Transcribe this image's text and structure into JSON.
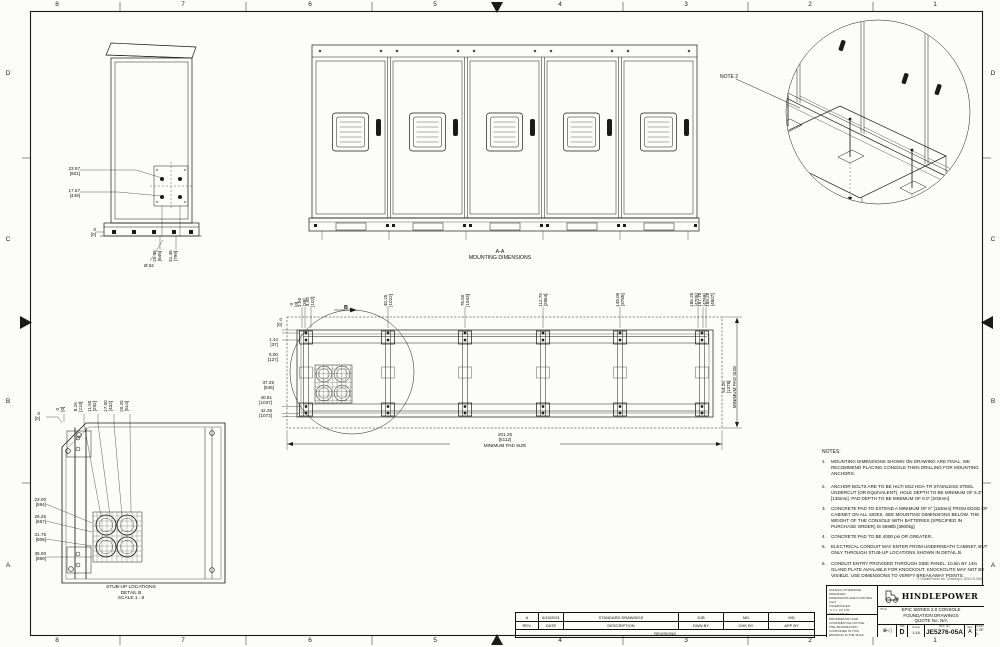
{
  "sheet": {
    "zones_h": [
      "8",
      "7",
      "6",
      "5",
      "4",
      "3",
      "2",
      "1"
    ],
    "zones_v": [
      "D",
      "C",
      "B",
      "A"
    ]
  },
  "side_view": {
    "dim_bolt_top": "23.67\n[601]",
    "dim_bolt_bot": "17.67\n[449]",
    "dim_zero": "0\n[0]",
    "dim_depth1": "25.45\n[646]",
    "dim_depth2": "31.46\n[799]",
    "dim_hole": "Ø.52"
  },
  "iso_view": {
    "note_label": "NOTE 2"
  },
  "plan_view": {
    "title": "A-A\nMOUNTING DIMENSIONS",
    "top_dims": [
      "0\n[0]",
      "1.50\n[38]",
      "4.00\n[102]",
      "40.25\n[1022]",
      "76.50\n[1943]",
      "112.75\n[2864]",
      "149.00\n[3785]",
      "185.25\n[4705]",
      "187.75\n[4769]",
      "189.25\n[4807]"
    ],
    "left_dims": [
      "0\n[0]",
      "1.44\n[37]",
      "5.00\n[127]",
      "37.25\n[946]",
      "40.81\n[1037]",
      "42.25\n[1073]"
    ],
    "right_dim": "54.25\n[1378]\nMINIMUM PAD SIZE",
    "bottom_dim": "201.25\n[5112]\nMINIMUM PAD SIZE",
    "detail_label": "B"
  },
  "detail_b": {
    "top_dims": [
      "0\n[0]",
      "8.25\n[210]",
      "11.50\n[292]",
      "17.00\n[432]",
      "20.25\n[514]"
    ],
    "left_zero": "0\n[0]",
    "left_dims": [
      "23.00\n[584]",
      "26.25\n[667]",
      "31.75\n[806]",
      "35.00\n[889]"
    ],
    "title": "STUB-UP LOCATIONS\nDETAIL B\nSCALE 1 : 8"
  },
  "notes": {
    "heading": "NOTES:",
    "items": [
      {
        "num": "1.",
        "text": "MOUNTING DIMENSIONS SHOWN ON DRAWING ARE FINAL. WE RECOMMEND PLACING CONSOLE THEN DRILLING FOR MOUNTING ANCHORS."
      },
      {
        "num": "2.",
        "text": "ANCHOR BOLTS ARE TO BE HILTI M12 HDA-TR STAINLESS STEEL UNDERCUT (OR EQUIVALENT). HOLE DEPTH TO BE MINIMUM OF 5.3\" [135mm]. PAD DEPTH TO BE MINIMUM OF 8.0\" [203mm]"
      },
      {
        "num": "3.",
        "text": "CONCRETE PAD TO EXTEND A MINIMUM OF 6\" [153mm] FROM EDGE OF CABINET ON ALL SIDES. SEE MOUNTING DIMENSIONS BELOW. THE WEIGHT OF THE CONSOLE WITH BATTERIES (SPECIFIED IN PURCHASE ORDER) IS 8598lb [3900kg]"
      },
      {
        "num": "4.",
        "text": "CONCRETE PAD TO BE 4000 psi OR GREATER."
      },
      {
        "num": "5.",
        "text": "ELECTRICAL CONDUIT MAY ENTER FROM UNDERNEATH CABINET, BUT ONLY THROUGH STUB-UP LOCATIONS SHOWN IN DETAIL B."
      },
      {
        "num": "6.",
        "text": "CONDUIT ENTRY PROVIDED THROUGH SIDE PANEL. 10.5in BY 14in GLAND PLATE AVAILABLE FOR KNOCKOUT. KNOCKOUTS MAY NOT BE VISIBLE. USE DIMENSIONS TO VERIFY BREAKAWAY POINTS."
      }
    ]
  },
  "revisions": {
    "caption": "REVISIONS",
    "headers": [
      "REV.",
      "DATE",
      "DESCRIPTION",
      "DWN BY",
      "CHK BY",
      "APP BY"
    ],
    "rows": [
      [
        "A",
        "6/15/2021",
        "STANDARD DRAWINGS",
        "SJB",
        "MD",
        "MD"
      ]
    ]
  },
  "title_block": {
    "company": "HINDLEPOWER",
    "title_label": "TITLE:",
    "title_line1": "EPIC SERIES 2.0 CONSOLE",
    "title_line2": "FOUNDATION DRAWINGS",
    "title_line3": "QUOTE No. N/A",
    "projection_glyph": "⊕◁",
    "size_label": "SIZE",
    "size": "D",
    "scale_label": "SCALE",
    "scale": "1:16",
    "dwg_label": "DWG. NO.",
    "dwg_no": "JE5276-05A",
    "rev_label": "REV",
    "rev": "A",
    "sheet_label": "SHEET",
    "sheet": "1 OF 1",
    "tolerance_note": "UNLESS OTHERWISE SPECIFIED:\nDIMENSIONS ARE IN INCHES [mm]\nTOLERANCES:\n.X ±.1   .XX ±.01\nANGULAR ±1°\nDO NOT SCALE DRAWING",
    "confidential_note": "PROPRIETARY AND CONFIDENTIAL NOTICE:\nTHE INFORMATION CONTAINED IN THIS\nDRAWING IS THE SOLE PROPERTY OF\nHINDLEPOWER INC. ANY REPRODUCTION\nWITHOUT WRITTEN PERMISSION IS\nPROHIBITED.",
    "copyright": "© HindlePower Inc.  Drawing # JE5276-05A"
  }
}
